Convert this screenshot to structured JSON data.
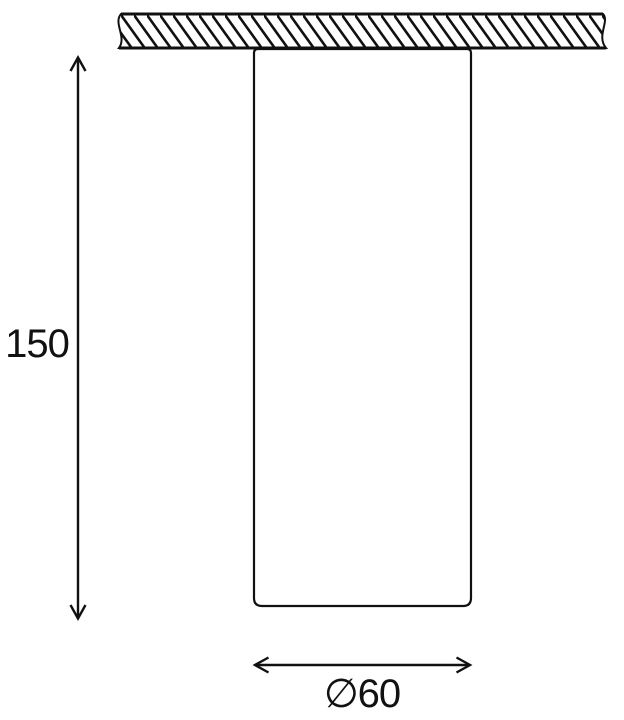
{
  "colors": {
    "line": "#111111",
    "background": "#ffffff"
  },
  "dimensions": {
    "height": {
      "label": "150"
    },
    "diameter": {
      "label": "∅60"
    }
  }
}
